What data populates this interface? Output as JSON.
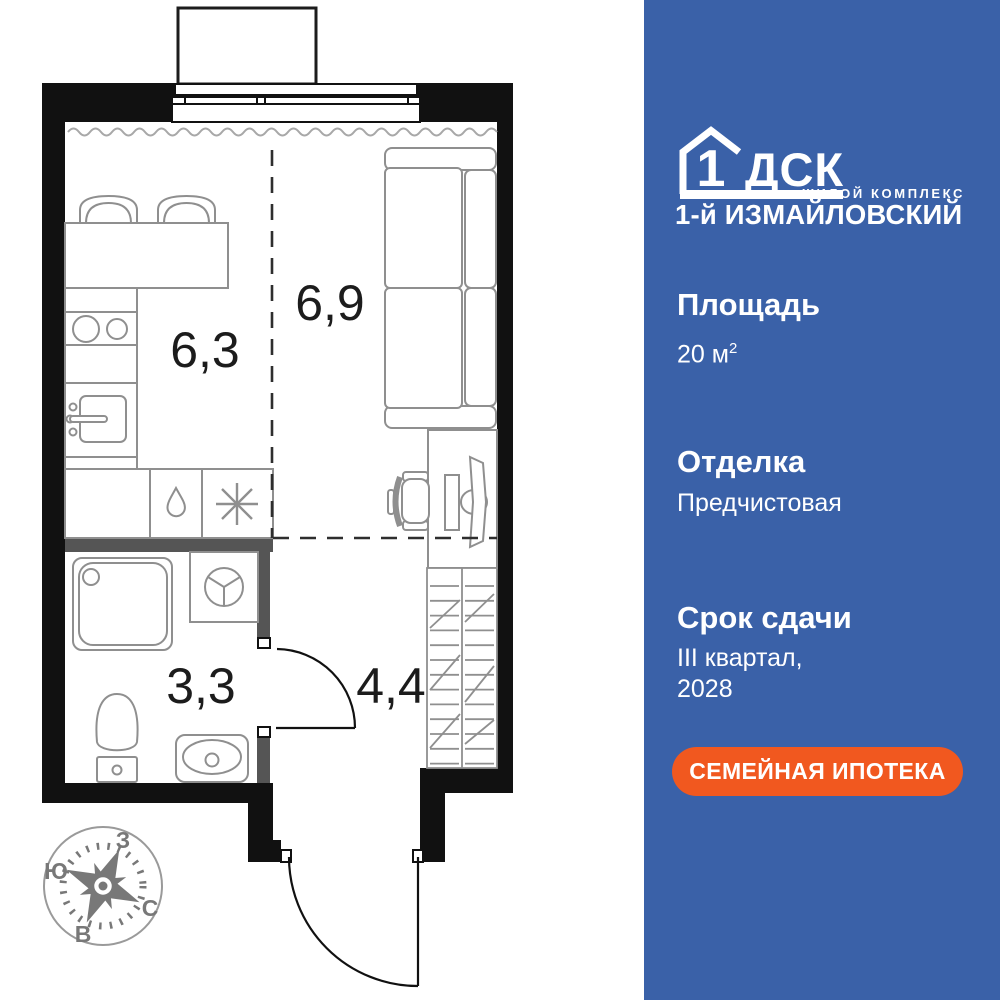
{
  "panel": {
    "logo": {
      "number": "1",
      "brand": "ДСК",
      "tagline": "ЖИЛОЙ КОМПЛЕКС",
      "complex_name": "1-й ИЗМАЙЛОВСКИЙ"
    },
    "area": {
      "title": "Площадь",
      "value": "20 м",
      "value_sup": "2"
    },
    "finish": {
      "title": "Отделка",
      "value": "Предчистовая"
    },
    "deadline": {
      "title": "Срок сдачи",
      "line1": "III квартал,",
      "line2": "2028"
    },
    "button": {
      "label": "СЕМЕЙНАЯ ИПОТЕКА"
    }
  },
  "plan": {
    "rooms": [
      {
        "id": "kitchen",
        "area": "6,3"
      },
      {
        "id": "living",
        "area": "6,9"
      },
      {
        "id": "bathroom",
        "area": "3,3"
      },
      {
        "id": "hall",
        "area": "4,4"
      }
    ]
  },
  "compass": {
    "west": "З",
    "south": "Ю",
    "north": "С",
    "east": "В"
  },
  "icons": {
    "logo_house": "house-outline",
    "kitchen_drop": "teardrop-shape",
    "kitchen_asterisk": "asterisk-shape",
    "compass": "compass-rose"
  },
  "colors": {
    "panel_blue": "#3a61a8",
    "accent_orange": "#f1581f",
    "wall_black": "#111111",
    "partition_gray": "#555555",
    "furniture_gray": "#8f8f8f"
  }
}
